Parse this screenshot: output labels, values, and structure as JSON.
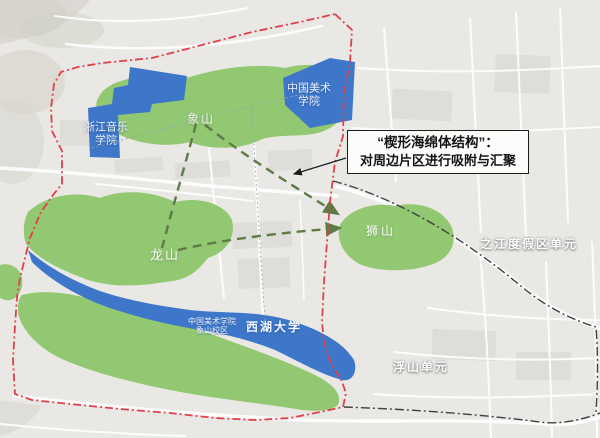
{
  "figure": {
    "description": "楔形海绵体结构 planning map"
  },
  "callout": {
    "title": "“楔形海绵体结构”：",
    "body": "对周边片区进行吸附与汇聚"
  },
  "labels": {
    "zhejiang_conservatory": {
      "line1": "浙江音乐",
      "line2": "学院"
    },
    "china_academy_of_art": {
      "line1": "中国美术",
      "line2": "学院"
    },
    "xiangshan_hill": "象山",
    "longshan_hill": "龙山",
    "shishan_hill": "狮山",
    "caa_xiangshan_campus": {
      "line1": "中国美术学院",
      "line2": "象山校区"
    },
    "westlake_university": "西湖大学",
    "zhijiang_resort_unit": "之江度假区单元",
    "fushan_unit": "浮山单元"
  },
  "colors": {
    "map_background": "#e9e8e5",
    "hill_green": "#92c871",
    "water_blue": "#3e77c9",
    "boundary_red": "#e04048",
    "unit_boundary_black": "#3f3f3f",
    "link_dash_green": "#5e7a45",
    "road_white": "#ffffff"
  }
}
